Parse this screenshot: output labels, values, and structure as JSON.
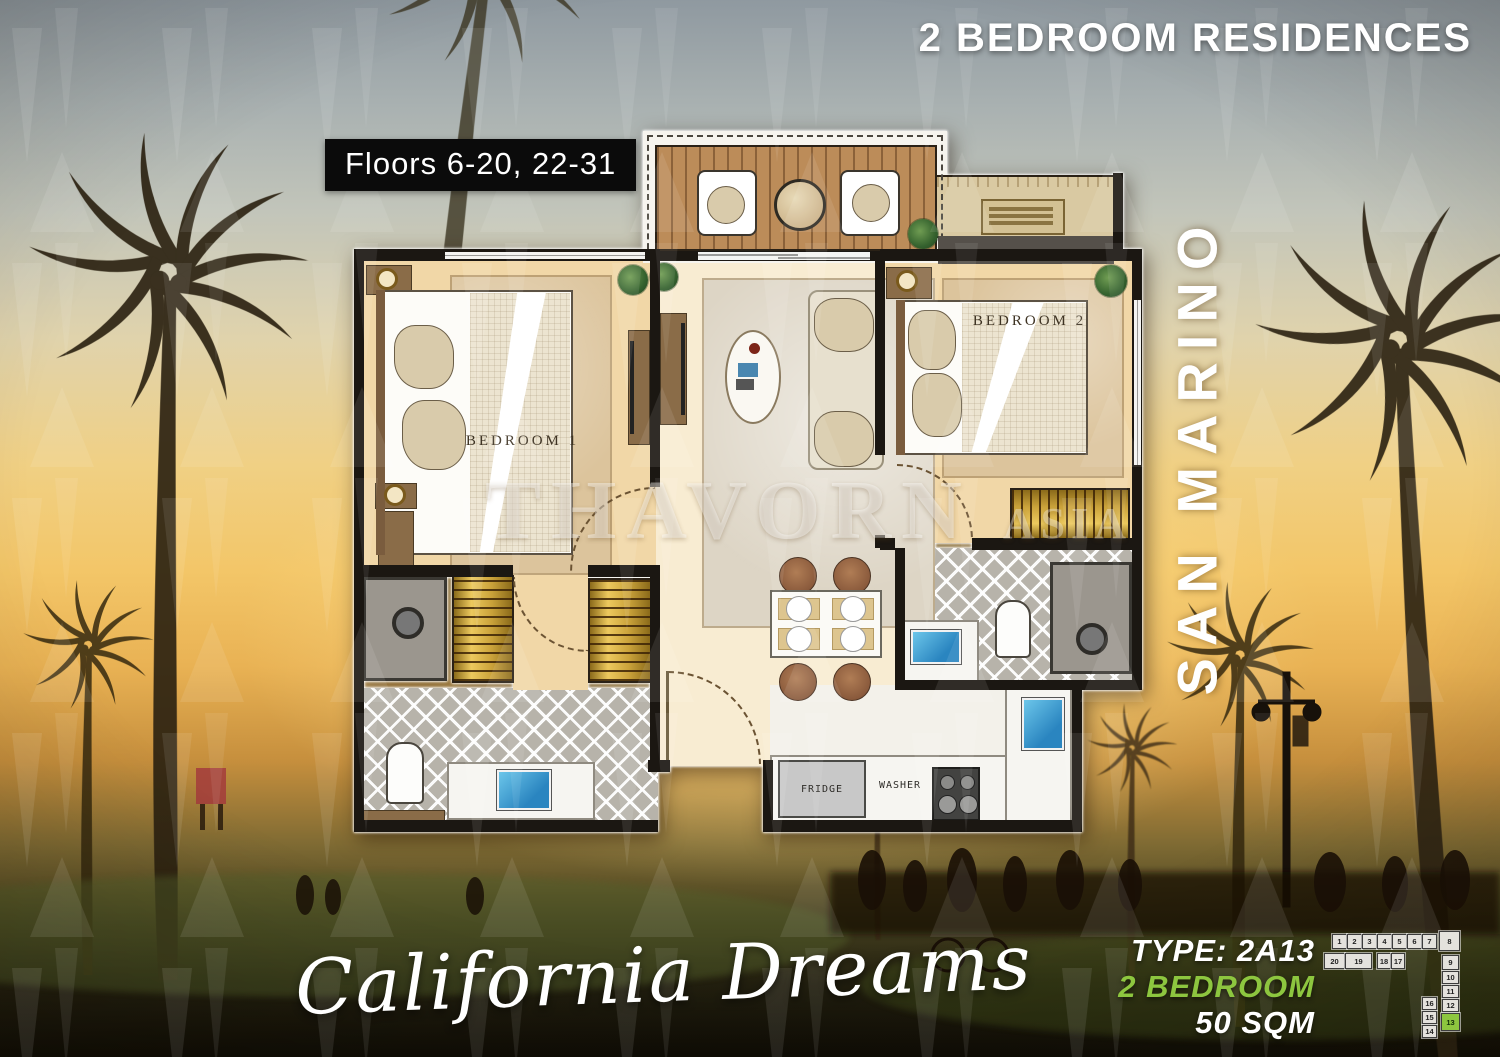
{
  "header": {
    "title": "2 BEDROOM RESIDENCES"
  },
  "floors_badge": {
    "label": "Floors 6-20, 22-31"
  },
  "building": {
    "name": "SAN MARINO"
  },
  "watermark": {
    "brand": "THAVORN",
    "suffix": "ASIA"
  },
  "script_title": {
    "text": "California Dreams"
  },
  "unit_info": {
    "type": "TYPE: 2A13",
    "bedrooms": "2 BEDROOM",
    "area": "50 SQM",
    "accent_color": "#8dc63f"
  },
  "plan": {
    "labels": {
      "bedroom1": "BEDROOM 1",
      "bedroom2": "BEDROOM 2",
      "fridge": "FRIDGE",
      "washer": "WASHER"
    }
  },
  "keyplan": {
    "highlight_color": "#8dc63f",
    "units": [
      {
        "n": "1",
        "x": 10,
        "y": 6,
        "w": 15,
        "h": 15
      },
      {
        "n": "2",
        "x": 25,
        "y": 6,
        "w": 15,
        "h": 15
      },
      {
        "n": "3",
        "x": 40,
        "y": 6,
        "w": 15,
        "h": 15
      },
      {
        "n": "4",
        "x": 55,
        "y": 6,
        "w": 15,
        "h": 15
      },
      {
        "n": "5",
        "x": 70,
        "y": 6,
        "w": 15,
        "h": 15
      },
      {
        "n": "6",
        "x": 85,
        "y": 6,
        "w": 15,
        "h": 15
      },
      {
        "n": "7",
        "x": 100,
        "y": 6,
        "w": 15,
        "h": 15
      },
      {
        "n": "8",
        "x": 117,
        "y": 3,
        "w": 21,
        "h": 20
      },
      {
        "n": "20",
        "x": 2,
        "y": 25,
        "w": 21,
        "h": 16
      },
      {
        "n": "19",
        "x": 23,
        "y": 25,
        "w": 27,
        "h": 16
      },
      {
        "n": "18",
        "x": 55,
        "y": 25,
        "w": 14,
        "h": 16
      },
      {
        "n": "17",
        "x": 69,
        "y": 25,
        "w": 14,
        "h": 16
      },
      {
        "n": "9",
        "x": 120,
        "y": 27,
        "w": 17,
        "h": 15
      },
      {
        "n": "10",
        "x": 120,
        "y": 43,
        "w": 17,
        "h": 13
      },
      {
        "n": "11",
        "x": 120,
        "y": 57,
        "w": 17,
        "h": 13
      },
      {
        "n": "12",
        "x": 120,
        "y": 71,
        "w": 17,
        "h": 13
      },
      {
        "n": "13",
        "x": 119,
        "y": 85,
        "w": 19,
        "h": 18,
        "highlight": true
      },
      {
        "n": "16",
        "x": 100,
        "y": 69,
        "w": 15,
        "h": 13
      },
      {
        "n": "15",
        "x": 100,
        "y": 83,
        "w": 15,
        "h": 13
      },
      {
        "n": "14",
        "x": 100,
        "y": 97,
        "w": 15,
        "h": 13
      }
    ]
  }
}
